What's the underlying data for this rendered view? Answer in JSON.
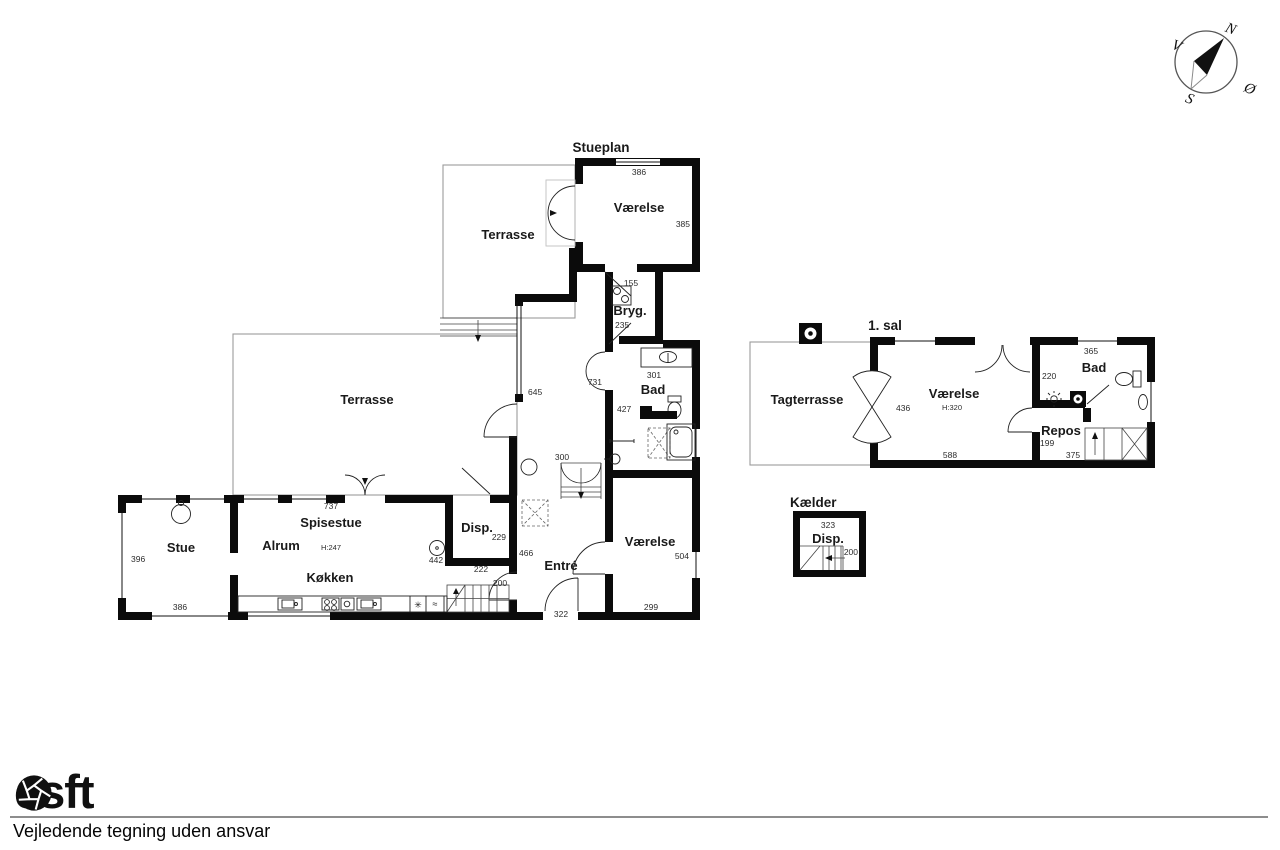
{
  "compass": {
    "north": "N",
    "west": "V",
    "south": "S",
    "east": "Ø"
  },
  "stueplan": {
    "title": "Stueplan",
    "terrasse_top": "Terrasse",
    "terrasse_main": "Terrasse",
    "vaerelse_top": "Værelse",
    "vaerelse_top_dims": {
      "width": "386",
      "height": "385"
    },
    "bryg": "Bryg.",
    "bryg_dims": {
      "width": "155",
      "height": "235"
    },
    "bad": "Bad",
    "bad_dims": {
      "width": "301",
      "height": "427"
    },
    "hall_dims": {
      "left": "645",
      "right": "731",
      "bottom": "300"
    },
    "stue": "Stue",
    "stue_dims": {
      "height": "396",
      "width": "386"
    },
    "alrum": "Alrum",
    "spisestue": "Spisestue",
    "spisestue_dims": {
      "width": "737"
    },
    "ceiling_height": "H:247",
    "koekken": "Køkken",
    "koekken_dims": {
      "width": "442"
    },
    "disp": "Disp.",
    "disp_dims": {
      "height": "229",
      "width": "222",
      "opening": "200"
    },
    "entre": "Entré",
    "entre_dims": {
      "height": "466",
      "width": "322"
    },
    "vaerelse_bottom": "Værelse",
    "vaerelse_bottom_dims": {
      "height": "504",
      "width": "299"
    }
  },
  "first_floor": {
    "title": "1. sal",
    "tagterrasse": "Tagterrasse",
    "vaerelse": "Værelse",
    "ceiling_height": "H:320",
    "vaerelse_dims": {
      "door": "436",
      "width": "588"
    },
    "bad": "Bad",
    "bad_dims": {
      "width": "365",
      "height": "220"
    },
    "repos": "Repos",
    "repos_dims": {
      "height": "199",
      "width": "375"
    }
  },
  "kaelder": {
    "title": "Kælder",
    "disp": "Disp.",
    "disp_dims": {
      "width": "323",
      "height": "200"
    }
  },
  "icons": {
    "freezer": "✳",
    "dishwasher": "≈"
  },
  "footer": {
    "logo_prefix": "es",
    "logo_suffix": "ft",
    "disclaimer": "Vejledende tegning uden ansvar"
  }
}
